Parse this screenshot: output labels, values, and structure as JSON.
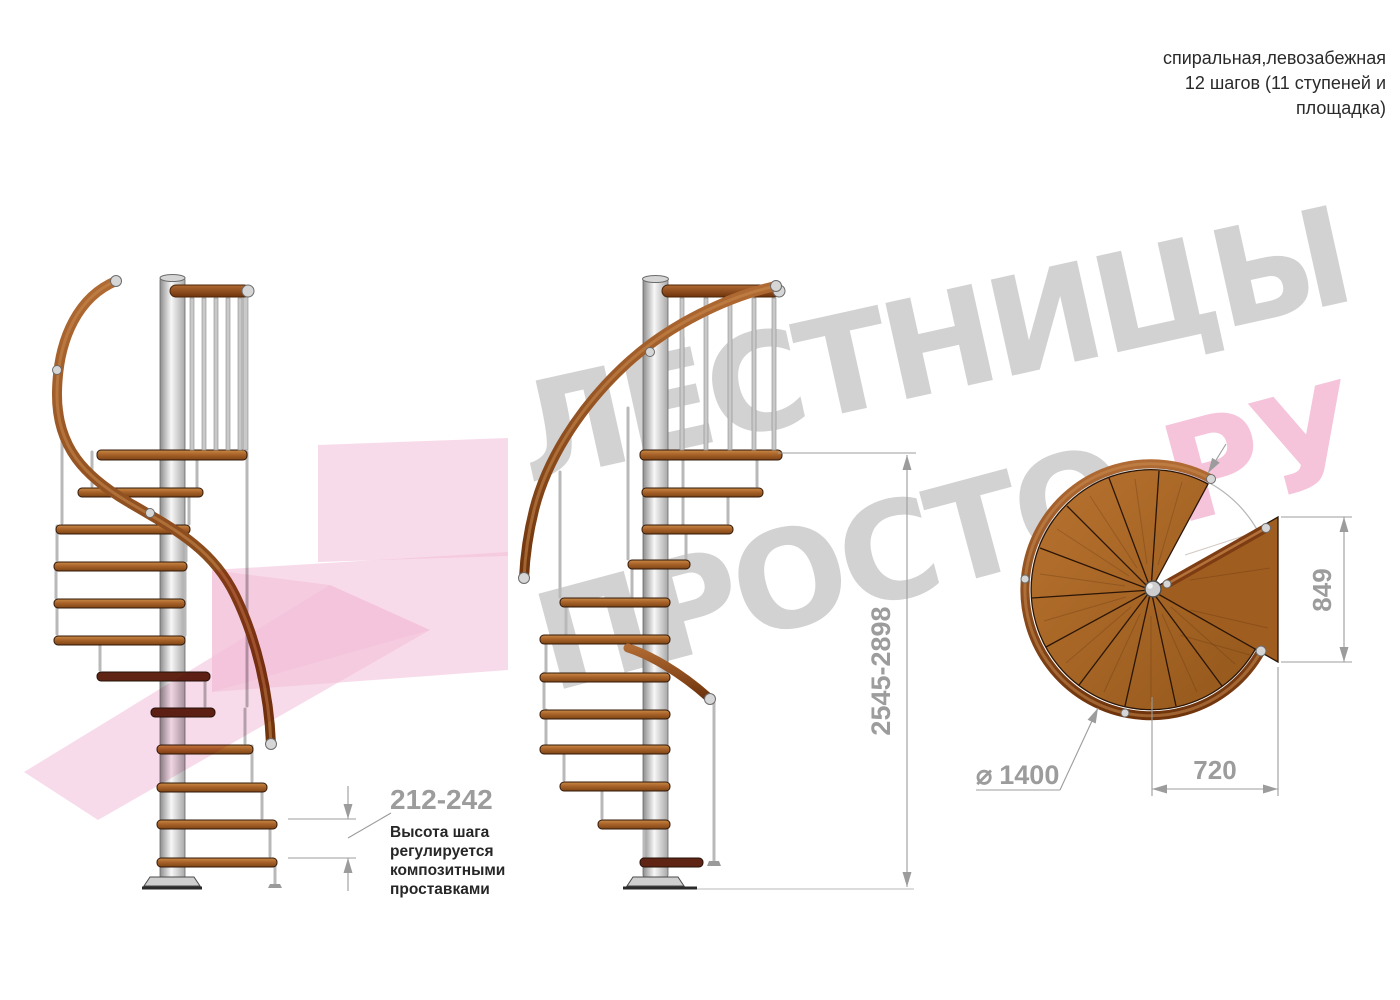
{
  "header": {
    "lines": [
      "спиральная,левозабежная",
      "12 шагов (11 ступеней и",
      "площадка)"
    ]
  },
  "watermark": {
    "line1": "ЛЕСТНИЦЫ",
    "line2_gray": "ПРОСТО",
    "line2_pink": ".РУ"
  },
  "dimensions": {
    "total_height": "2545-2898",
    "step_height": "212-242",
    "step_note_lines": [
      "Высота шага",
      "регулируется",
      "композитными",
      "проставками"
    ],
    "diameter_symbol": "⌀",
    "diameter_value": "1400",
    "landing_width": "720",
    "landing_depth": "849"
  },
  "views": {
    "count_side_views": 2,
    "count_plan_views": 1,
    "treads_per_view": 11,
    "levels_with_landing": 12
  },
  "colors": {
    "accent_wood": "#a9632a",
    "wood_dark": "#5f2414",
    "handrail": "#7d3c12",
    "metal": "#b9b9b9",
    "dimension_gray": "#9c9c9c",
    "note_ink": "#262626",
    "watermark_gray": "#d2d2d2",
    "watermark_pink": "#f5c3da",
    "pink_arrow": "#f3bed8",
    "background": "#ffffff"
  }
}
